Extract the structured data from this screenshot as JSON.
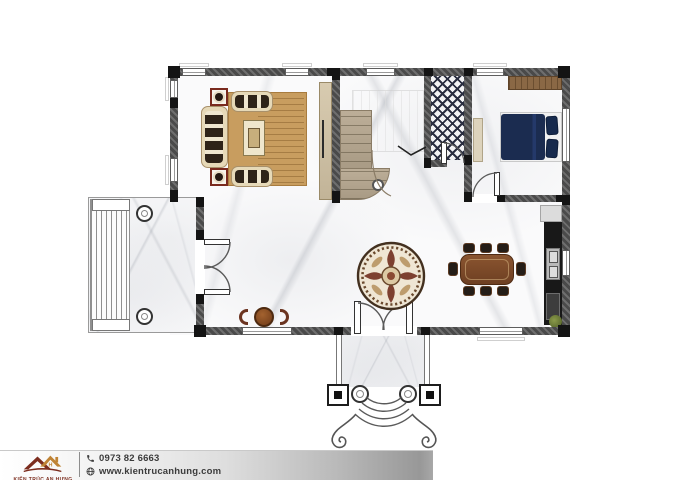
{
  "footer": {
    "brand": {
      "name": "KIẾN TRÚC AN HƯNG",
      "logo_icon": "double-roof-logo"
    },
    "contact": {
      "phone": {
        "icon": "phone-icon",
        "number": "0973 82 6663"
      },
      "website": {
        "icon": "globe-icon",
        "url": "www.kientrucanhung.com"
      }
    }
  },
  "floorplan": {
    "type": "architectural-ground-floor-plan",
    "rooms": [
      {
        "name": "living-room",
        "furniture": [
          "sofa-set",
          "coffee-table",
          "tv-cabinet",
          "striped-rug",
          "side-tables-with-lamps"
        ]
      },
      {
        "name": "stair-hall",
        "furniture": [
          "curved-staircase",
          "upper-flight-outline",
          "floor-medallion",
          "cafe-table-with-two-chairs"
        ]
      },
      {
        "name": "bathroom",
        "furniture": [
          "diamond-lattice-tile-floor"
        ]
      },
      {
        "name": "bedroom",
        "furniture": [
          "double-bed-navy",
          "wardrobe",
          "dresser"
        ]
      },
      {
        "name": "kitchen-dining",
        "furniture": [
          "dining-table-with-8-chairs",
          "kitchen-counter",
          "double-sink",
          "stove",
          "corner-plant"
        ]
      },
      {
        "name": "side-porch",
        "furniture": [
          "deck-steps",
          "two-round-columns",
          "double-door"
        ]
      },
      {
        "name": "entrance-porch",
        "furniture": [
          "double-entry-door",
          "two-square-columns",
          "two-round-columns",
          "curved-steps",
          "scroll-volutes"
        ]
      }
    ],
    "colors": {
      "floor_marble": "#fafafb",
      "wall": "#4a4a4a",
      "wall_post": "#141414",
      "rug": "#c89d5f",
      "sofa": "#e6d9b8",
      "bed_navy": "#1b2c50",
      "dining_table": "#6e3f22",
      "stairs": "#b0a28c",
      "kitchen_counter": "#181818",
      "bath_tile": "#2a2e40",
      "medallion_accent": "#7d4030",
      "brand_red": "#7c2d1e",
      "brand_tan": "#bf8335",
      "footer_text": "#3b3b3b"
    }
  }
}
